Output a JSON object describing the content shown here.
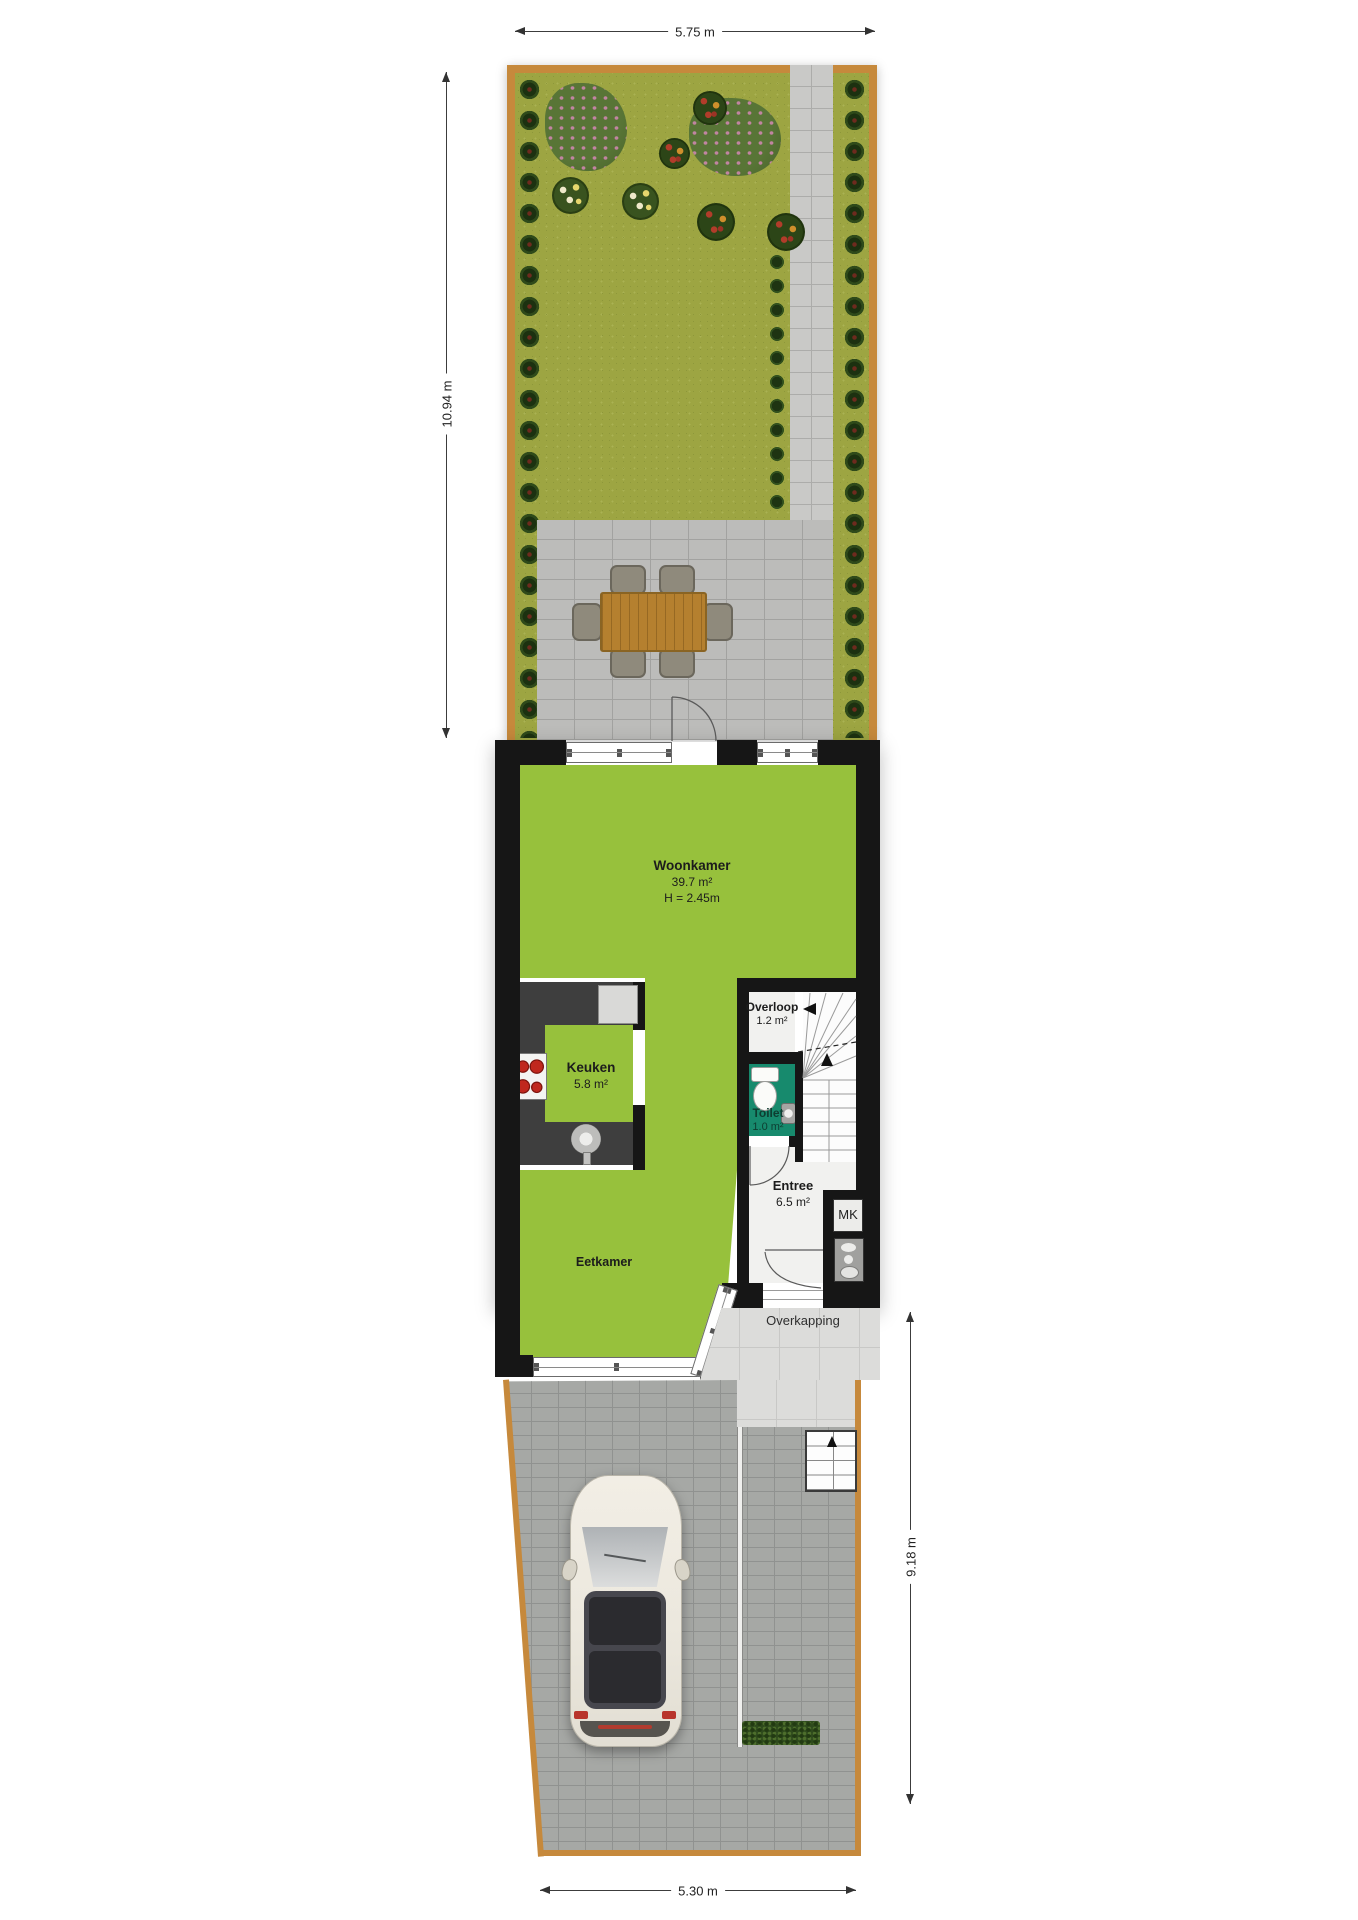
{
  "plan": {
    "dims": {
      "top": "5.75 m",
      "left": "10.94 m",
      "right": "9.18 m",
      "bottom": "5.30 m"
    },
    "rooms": {
      "woonkamer": {
        "name": "Woonkamer",
        "area": "39.7 m²",
        "height": "H = 2.45m"
      },
      "keuken": {
        "name": "Keuken",
        "area": "5.8 m²"
      },
      "overloop": {
        "name": "Overloop",
        "area": "1.2 m²"
      },
      "toilet": {
        "name": "Toilet",
        "area": "1.0 m²"
      },
      "entree": {
        "name": "Entree",
        "area": "6.5 m²"
      },
      "eetkamer": {
        "name": "Eetkamer"
      },
      "mk": {
        "name": "MK"
      },
      "overkapping": {
        "name": "Overkapping"
      }
    },
    "colors": {
      "room_green": "#97c13c",
      "toilet_teal": "#178a6d",
      "wall_black": "#161616",
      "fence_tan": "#c6893c",
      "grass_olive": "#9da542"
    }
  }
}
